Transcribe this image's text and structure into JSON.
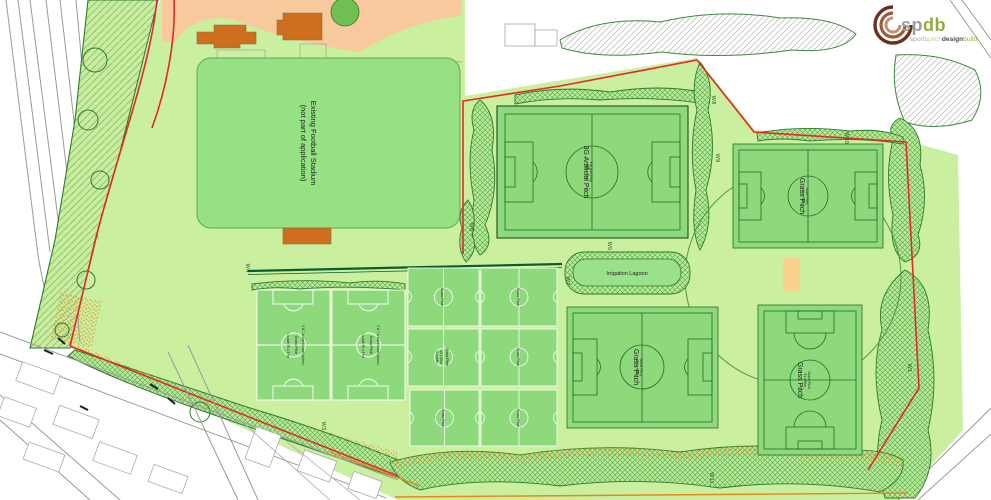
{
  "logo": {
    "abbr_part1": "sp",
    "abbr_part2": "db",
    "word1": "sports",
    "word2": "pitch",
    "word3": "design",
    "word4": "build"
  },
  "stadium": {
    "label_line1": "Existing Football Stadium",
    "label_line2": "(not part of application)"
  },
  "lagoon": {
    "label": "Irrigation Lagoon"
  },
  "pitches": {
    "artificial_3g": {
      "label": "3G Artificial Pitch",
      "dims_line1": "Full Size Pitch",
      "dims_line2": "106 x 70m"
    },
    "grass_north_east": {
      "label": "Grass Pitch",
      "dims_line1": "Junior Pitch",
      "dims_line2": "82 x 50m"
    },
    "grass_south": {
      "label": "Grass Pitch",
      "dims_line1": "Senior Pitch",
      "dims_line2": "100 x 64m"
    },
    "grass_south_east": {
      "label": "Grass Pitch",
      "dims_line1": "Senior Pitch",
      "dims_line2": "91 x 56m"
    },
    "junior_west_a": {
      "label": "Grass Pitch",
      "dims": "7-a-side 55 x 37m",
      "note": "5 & 7-a-side football pitches"
    },
    "junior_west_b": {
      "label": "Grass Pitch",
      "dims": "7-a-side 55 x 37m",
      "note": "5 & 7-a-side football pitches"
    },
    "mini": {
      "label": "Grass Pitch",
      "note_line1": "5-a-side",
      "note_line2": "40 x 30m"
    }
  },
  "w_labels": {
    "w1": "W1",
    "w3": "W3",
    "w4": "W4",
    "w5": "W5",
    "w6": "W6",
    "w7": "W7",
    "w8": "W8",
    "w9": "W9",
    "w10": "W10",
    "w11": "W11"
  },
  "colors": {
    "site_green": "#c9ef9f",
    "pitch_green": "#8dd97c",
    "stadium_green": "#95e184",
    "marking_green": "#2a6b2a",
    "boundary_red": "#e8262b",
    "existing_area_peach": "#f7c99c",
    "building_orange": "#ce6e1e",
    "cricket_square_beige": "#f8d38e",
    "hedge_green": "#0b5c2e",
    "access_orange": "#e8861d"
  }
}
